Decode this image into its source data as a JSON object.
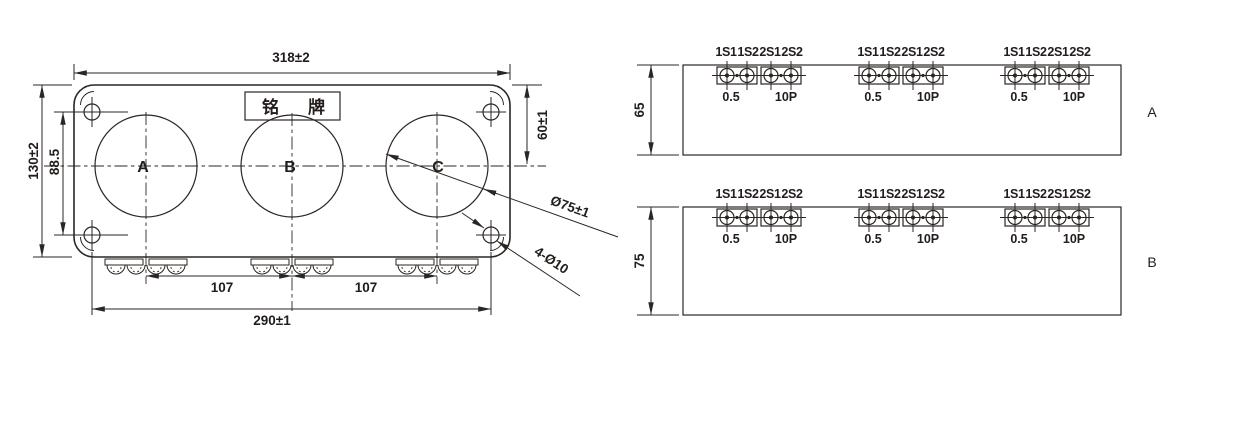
{
  "front_view": {
    "nameplate_label": "铭牌",
    "phase_labels": [
      "A",
      "B",
      "C"
    ],
    "dimensions": {
      "overall_width": "318±2",
      "overall_height": "130±2",
      "mount_hole_vertical_pitch": "88.5",
      "top_to_window_center": "60±1",
      "window_diameter": "Ø75±1",
      "mount_holes": "4-Ø10",
      "phase_pitch_left": "107",
      "phase_pitch_right": "107",
      "mount_hole_horizontal_pitch": "290±1"
    }
  },
  "terminal_views": [
    {
      "view_label": "A",
      "depth_dimension": "65"
    },
    {
      "view_label": "B",
      "depth_dimension": "75"
    }
  ],
  "terminal_block": {
    "terminal_markings": "1S1 1S2 2S1 2S2",
    "metering_class": "0.5",
    "protection_class": "10P"
  }
}
